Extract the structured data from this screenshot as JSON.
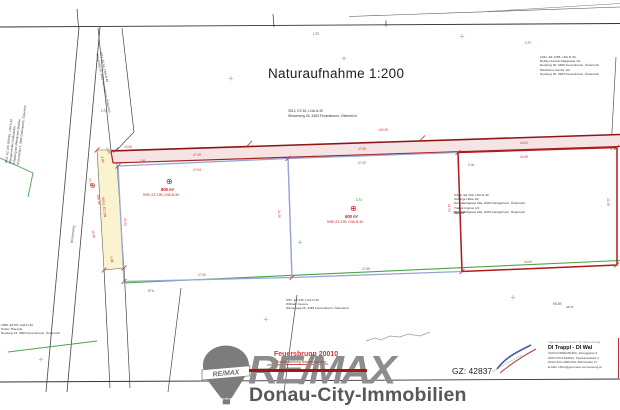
{
  "document": {
    "title": "Naturaufnahme 1:200",
    "scale": "1:200",
    "plan_name": "Feuersbrunn 20010",
    "plan_subtitle": "Plandarstellung Naturaufnahme",
    "gz": "GZ: 42837"
  },
  "branding": {
    "logo_text": "RE/MAX",
    "balloon_text": "RE/MAX",
    "company": "Donau-City-Immobilien",
    "accent_red": "#a81315",
    "logo_gray": "#8d8d8d"
  },
  "surveyor": {
    "heading": "Ingenieurkonsulenten für Vermessung",
    "names": "DI Trappl - DI Wal",
    "lines": [
      "2100 KORNEUBURG, Zwinggasse 9",
      "2000 STOCKERAU, Sparkassaplatz 4",
      "2020 HOLLABRUNN, Bahnstraße 27",
      "E-Mail: office@geometer-vermessung.at"
    ]
  },
  "colors": {
    "boundary_red": "#b21a1a",
    "strip_pink": "#f6e4e4",
    "parcel_lavender": "#9aa4d8",
    "boundary_green": "#4aa44a",
    "road_yellow": "#faf3cf",
    "dimension_red": "#c03030"
  },
  "plan": {
    "labels": [
      {
        "name": "ln-label",
        "text": "LN",
        "x": 313,
        "y": 31,
        "size": 4.5,
        "color": "#56a856"
      },
      {
        "name": "ln-label",
        "text": "LN",
        "x": 525,
        "y": 40,
        "size": 4.5,
        "color": "#56a856"
      },
      {
        "name": "ln-label",
        "text": "LN",
        "x": 101,
        "y": 108,
        "size": 4.5,
        "color": "#56a856"
      },
      {
        "name": "ln-label",
        "text": "LN",
        "x": 356,
        "y": 197,
        "size": 4.5,
        "color": "#56a856"
      },
      {
        "name": "parcel-symbol",
        "text": "⊕",
        "x": 166,
        "y": 177,
        "size": 8,
        "color": "#c02020"
      },
      {
        "name": "parcel-symbol",
        "text": "⊕",
        "x": 350,
        "y": 204,
        "size": 8,
        "color": "#c02020"
      },
      {
        "name": "parcel-symbol",
        "text": "⊕",
        "x": 96,
        "y": 182,
        "size": 7,
        "color": "#c02020",
        "rotate": 80
      },
      {
        "name": "parcel-area",
        "text": "800 m²",
        "x": 161,
        "y": 187,
        "size": 4.2,
        "color": "#c02020",
        "bold": true
      },
      {
        "name": "parcel-id",
        "text": "9/99, EZ 199, LNA.N.40",
        "x": 143,
        "y": 193,
        "size": 3.4,
        "color": "#c02020"
      },
      {
        "name": "parcel-area",
        "text": "600 m²",
        "x": 345,
        "y": 214,
        "size": 4.2,
        "color": "#c02020",
        "bold": true
      },
      {
        "name": "parcel-id",
        "text": "9/98, EZ 199, LNA.N.40",
        "x": 327,
        "y": 220,
        "size": 3.4,
        "color": "#c02020"
      },
      {
        "name": "parcel-area",
        "text": "788 m²",
        "x": 453,
        "y": 211,
        "size": 3.8,
        "color": "#c02020",
        "bold": true
      },
      {
        "name": "point-label",
        "text": "57 b",
        "x": 148,
        "y": 289,
        "size": 3.2,
        "color": "#555"
      },
      {
        "name": "point-label",
        "text": "9/159",
        "x": 553,
        "y": 302,
        "size": 3.4,
        "color": "#555"
      },
      {
        "name": "point-label",
        "text": "48.94",
        "x": 566,
        "y": 306,
        "size": 3,
        "color": "#555"
      },
      {
        "name": "road-label",
        "text": "Winzerweg",
        "x": 70,
        "y": 243,
        "size": 3.6,
        "color": "#555",
        "rotate": -84
      },
      {
        "name": "strip-area",
        "text": "156 m²",
        "x": 100,
        "y": 194,
        "size": 3.4,
        "color": "#c02020",
        "rotate": 84
      },
      {
        "name": "strip-id",
        "text": "9/161, EZ 199",
        "x": 105,
        "y": 197,
        "size": 3.2,
        "color": "#c02020",
        "rotate": 84
      }
    ],
    "blocks": [
      {
        "name": "owner-block-center",
        "x": 288,
        "y": 109,
        "size": 3.4,
        "color": "#333",
        "gap": 3,
        "lines": [
          "3912, EZ 62, LNA.N.40",
          "Winzerweg 26, 3483 Feuersbrunn, Österreich"
        ]
      },
      {
        "name": "owner-block-topright",
        "x": 540,
        "y": 55,
        "size": 3.1,
        "color": "#333",
        "lines": [
          "1941, EZ 1258, LNA.N.40",
          "Rythler Kerstin Margarete 1/2",
          "Neuberg 30, 3483 Feuersbrunn, Österreich",
          "Windstoss Gunter 1/2",
          "Neuberg 30, 3483 Feuersbrunn, Österreich"
        ]
      },
      {
        "name": "owner-block-right-parcel",
        "x": 454,
        "y": 193,
        "size": 3.1,
        "color": "#333",
        "lines": [
          "9/162, EZ 199, LNA.N.40",
          "Göttinger Elke 1/2",
          "Grunddorfgasse 29a, 2020 Königsbrunn, Österreich",
          "Trabek Ingmar 1/2",
          "Grunddorfgasse 29a, 2020 Königsbrunn, Österreich"
        ]
      },
      {
        "name": "owner-block-bottom",
        "x": 286,
        "y": 298,
        "size": 3.1,
        "color": "#333",
        "lines": [
          "9/97, EZ 446, LNA.N.40",
          "Withalm Verena",
          "Winzerweg 26, 3483 Feuersbrunn, Österreich"
        ]
      },
      {
        "name": "owner-block-bottomleft",
        "x": 1,
        "y": 323,
        "size": 3.1,
        "color": "#333",
        "lines": [
          "1955, EZ 55, LNA.N.40",
          "Huber Theresia",
          "Neuberg 24, 3483 Feuersbrunn, Österreich"
        ]
      },
      {
        "name": "owner-block-left-rotated",
        "x": 4,
        "y": 163,
        "size": 3,
        "color": "#333",
        "rotate": -83,
        "lines": [
          "3922, EZ 100, BRGBL, LNA.N.40",
          "Marktgemeinde Grafenwörth",
          "Erhaltung der öffentlichen Straßen",
          "Kirchenplatz 3, 3484 Grafenwörth, Österreich"
        ]
      },
      {
        "name": "parcel-block-wedge",
        "x": 103,
        "y": 52,
        "size": 3,
        "color": "#333",
        "rotate": 78,
        "lines": [
          "9/13, EZ 62, LNA.N.40",
          "Winzerweg 26, 3483 Feuersbrunn, Österreich"
        ]
      }
    ],
    "dimensions": [
      {
        "text": "15.08",
        "x": 124,
        "y": 145,
        "rotate": -2
      },
      {
        "text": "129.46",
        "x": 378,
        "y": 128,
        "rotate": -2
      },
      {
        "text": "27.98",
        "x": 193,
        "y": 153,
        "rotate": -2
      },
      {
        "text": "27.96",
        "x": 358,
        "y": 147,
        "rotate": -2
      },
      {
        "text": "34.02",
        "x": 520,
        "y": 141,
        "rotate": -2
      },
      {
        "text": "27.94",
        "x": 193,
        "y": 168,
        "rotate": -2
      },
      {
        "text": "27.92",
        "x": 358,
        "y": 161,
        "rotate": -2
      },
      {
        "text": "33.98",
        "x": 520,
        "y": 155,
        "rotate": -2
      },
      {
        "text": "27.90",
        "x": 198,
        "y": 273,
        "rotate": -2
      },
      {
        "text": "27.88",
        "x": 362,
        "y": 267,
        "rotate": -2
      },
      {
        "text": "34.06",
        "x": 524,
        "y": 260,
        "rotate": -2
      },
      {
        "text": "21.56",
        "x": 281,
        "y": 210,
        "rotate": 87
      },
      {
        "text": "21.54",
        "x": 451,
        "y": 204,
        "rotate": 87
      },
      {
        "text": "21.60",
        "x": 610,
        "y": 198,
        "rotate": 87
      },
      {
        "text": "21.52",
        "x": 127,
        "y": 218,
        "rotate": 87
      },
      {
        "text": "4.00",
        "x": 104,
        "y": 156,
        "rotate": 80
      },
      {
        "text": "3.98",
        "x": 113,
        "y": 256,
        "rotate": 80
      },
      {
        "text": "12.10",
        "x": 92,
        "y": 178,
        "rotate": 82
      },
      {
        "text": "15.95",
        "x": 95,
        "y": 230,
        "rotate": 82
      },
      {
        "text": "7.58",
        "x": 139,
        "y": 159,
        "rotate": -2
      },
      {
        "text": "5.04",
        "x": 468,
        "y": 163,
        "rotate": -2
      },
      {
        "text": "1.80",
        "x": 109,
        "y": 147,
        "rotate": 70
      }
    ],
    "crosses": [
      {
        "x": 231,
        "y": 80,
        "color": "#8fbc8f"
      },
      {
        "x": 462,
        "y": 38,
        "color": "#8fbc8f"
      },
      {
        "x": 344,
        "y": 60,
        "color": "#a9a9a9"
      },
      {
        "x": 300,
        "y": 244,
        "color": "#8fbc8f"
      },
      {
        "x": 266,
        "y": 321,
        "color": "#8fbc8f"
      },
      {
        "x": 41,
        "y": 361,
        "color": "#8fbc8f"
      },
      {
        "x": 513,
        "y": 299,
        "color": "#8fbc8f"
      }
    ]
  }
}
